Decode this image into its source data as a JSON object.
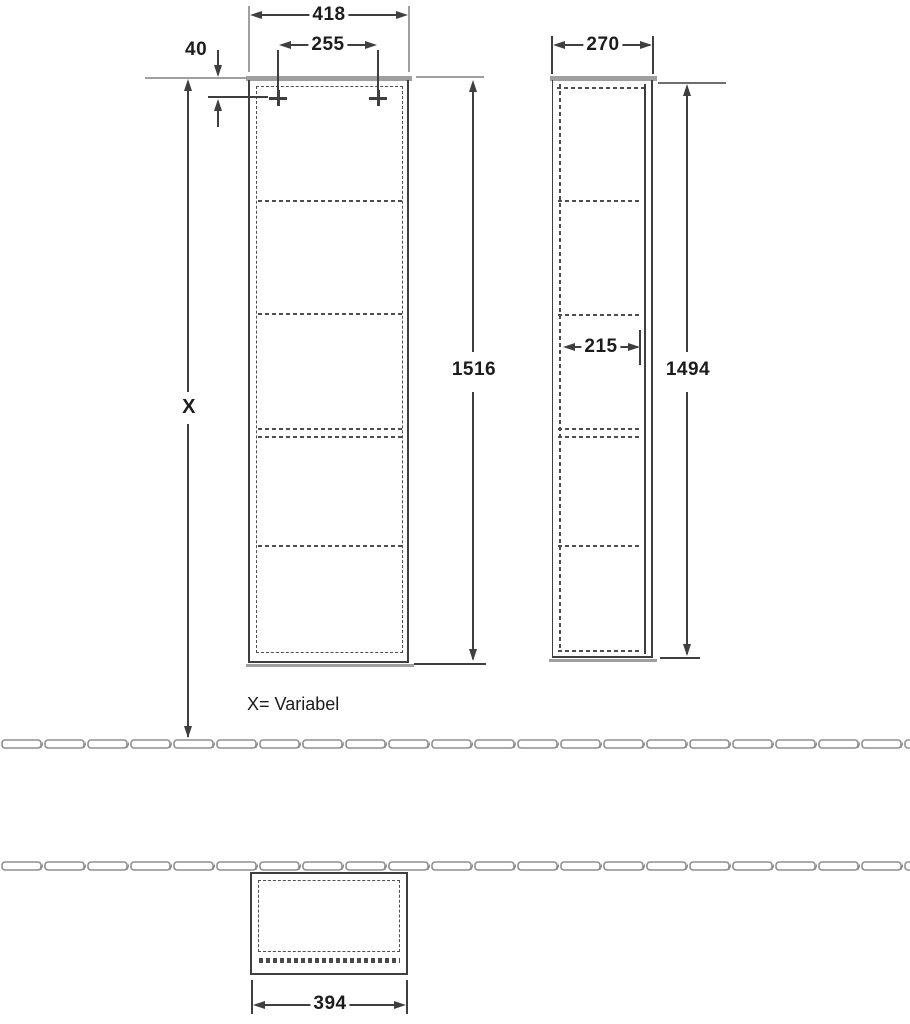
{
  "dims": {
    "front_width": "418",
    "front_inner_width": "255",
    "top_offset": "40",
    "front_height": "1516",
    "variable_height": "X",
    "side_depth": "270",
    "side_inner_depth": "215",
    "side_height": "1494",
    "top_view_width": "394"
  },
  "note": "X= Variabel",
  "colors": {
    "line": "#3f3f3f",
    "light_line": "#9f9f9f",
    "text": "#1c1c1c",
    "background": "#ffffff"
  }
}
